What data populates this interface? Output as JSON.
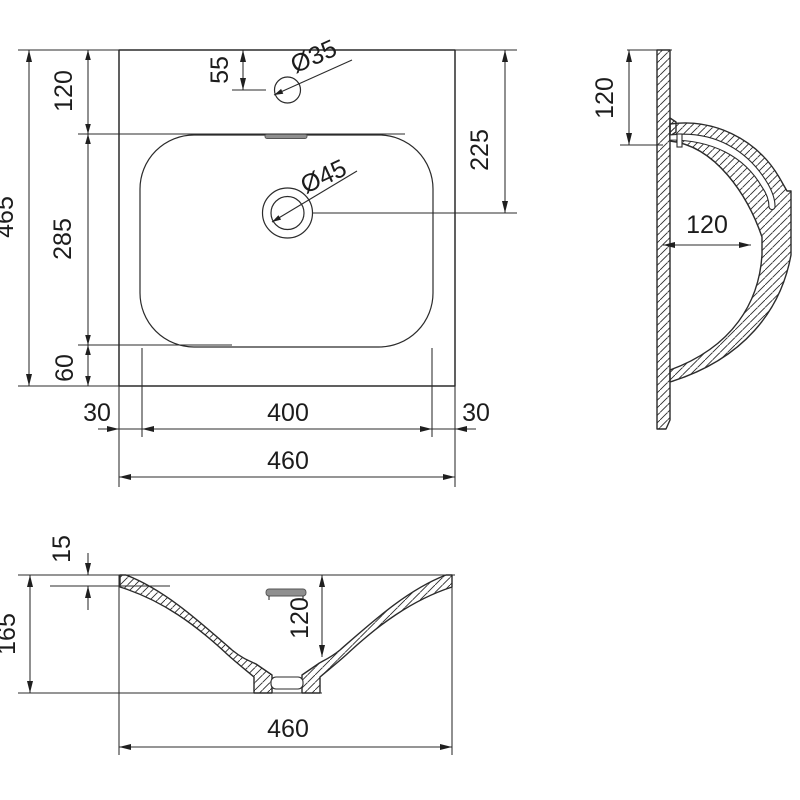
{
  "drawing": {
    "subject": "washbasin-dimensioned-technical-drawing",
    "colors": {
      "line": "#2b2b2b",
      "background": "#ffffff",
      "overflow_slot": "#8f8f8f"
    },
    "plan_view": {
      "dims": {
        "height_total": "465",
        "top_to_basin": "120",
        "basin_length": "285",
        "basin_to_bottom": "60",
        "faucet_offset": "55",
        "faucet_hole_dia": "Ø35",
        "drain_hole_dia": "Ø45",
        "top_to_drain": "225",
        "margin_left": "30",
        "basin_width": "400",
        "margin_right": "30",
        "width_total": "460"
      }
    },
    "side_view": {
      "dims": {
        "rim_drop": "120",
        "rim_depth": "120"
      }
    },
    "front_view": {
      "dims": {
        "rim_thickness": "15",
        "depth_total": "165",
        "bowl_depth": "120",
        "width_total": "460"
      }
    }
  }
}
